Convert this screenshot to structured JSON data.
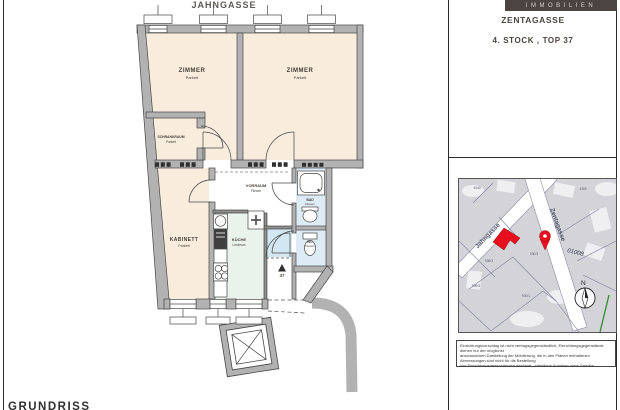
{
  "header": {
    "street_top": "JAHNGASSE",
    "brand": "IMMOBILIEN",
    "street_right": "ZENTAGASSE",
    "unit": "4. STOCK , TOP 37"
  },
  "plan": {
    "rooms": {
      "zimmer1": {
        "name": "ZIMMER",
        "floor": "Parkett"
      },
      "zimmer2": {
        "name": "ZIMMER",
        "floor": "Parkett"
      },
      "schrankraum": {
        "name": "SCHRANKRAUM",
        "floor": "Parkett"
      },
      "kabinett": {
        "name": "KABINETT",
        "floor": "Parkett"
      },
      "kueche": {
        "name": "KÜCHE",
        "floor": "Linoleum"
      },
      "vorraum": {
        "name": "VORRAUM",
        "floor": "Fliesen"
      },
      "bad": {
        "name": "BAD",
        "floor": "Fliesen"
      },
      "wc": {
        "name": "WC",
        "floor": "Fliesen"
      }
    },
    "entrance_number": "37",
    "colors": {
      "wall": "#b2b2b2",
      "room_warm": "#f8ecdd",
      "room_mint": "#e9f3ec",
      "room_blue": "#dcebf4",
      "brand_bg": "#4c4440"
    }
  },
  "map": {
    "streets": [
      "Jahngasse",
      "Zentagasse"
    ],
    "district_code": "01008",
    "parcels": [
      "4040",
      "4365",
      "930/3",
      "936/3",
      "939/3",
      "930/1"
    ],
    "compass_label": "N",
    "highlight_color": "#e8101f"
  },
  "disclaimer": {
    "lines": [
      "Einrichtungsvorschlag ist nicht vertragsgegenständlich, Einrichtungsgegenstände dienen nur der möglichst",
      "anschaulichen Darstellung der Möblierung, die in den Plänen enthaltenen Abmessungen sind nicht für die Bestellung",
      "von Einrichtungsgegenständen geeignet - sämtliche Angaben ohne Gewähr."
    ]
  },
  "footer": {
    "caption": "GRUNDRISS"
  }
}
